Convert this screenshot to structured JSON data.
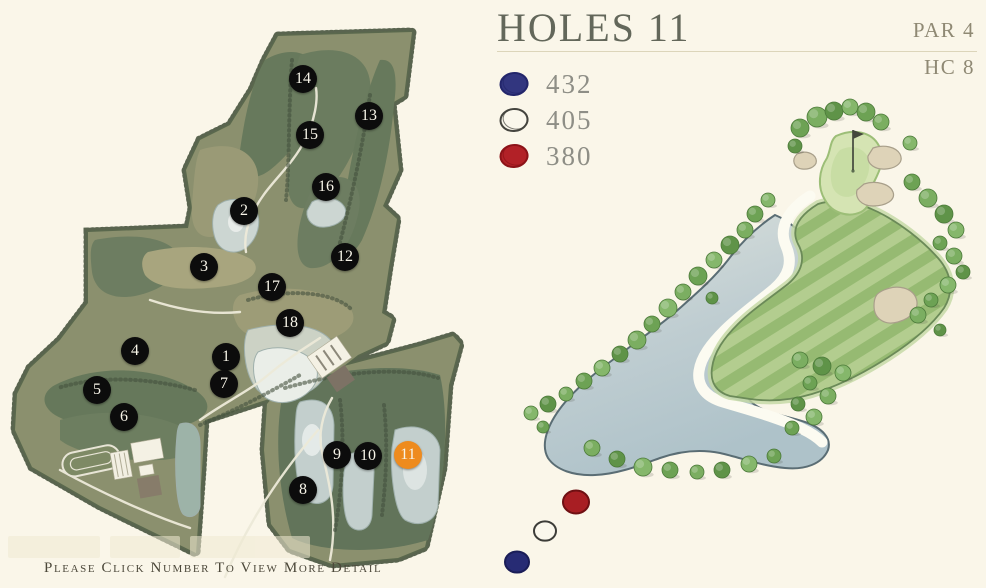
{
  "window": {
    "background": "#faf6e9"
  },
  "header": {
    "title": "HOLES 11",
    "par": "PAR 4",
    "handicap": "HC 8"
  },
  "legend": {
    "tees": [
      {
        "name": "blue-tee",
        "distance": "432",
        "fill": "#32367f",
        "outline": "#23266b"
      },
      {
        "name": "white-tee",
        "distance": "405",
        "fill": "#faf7ec",
        "outline": "#45453f"
      },
      {
        "name": "red-tee",
        "distance": "380",
        "fill": "#b22127",
        "outline": "#8c1318"
      }
    ]
  },
  "map": {
    "instruction": "Please Click Number To View More Detail",
    "active_color": "#ee8b1e",
    "marker_color": "#0c0c0c",
    "holes": [
      {
        "number": "1",
        "x": 226,
        "y": 357,
        "active": false
      },
      {
        "number": "2",
        "x": 244,
        "y": 211,
        "active": false
      },
      {
        "number": "3",
        "x": 204,
        "y": 267,
        "active": false
      },
      {
        "number": "4",
        "x": 135,
        "y": 351,
        "active": false
      },
      {
        "number": "5",
        "x": 97,
        "y": 390,
        "active": false
      },
      {
        "number": "6",
        "x": 124,
        "y": 417,
        "active": false
      },
      {
        "number": "7",
        "x": 224,
        "y": 384,
        "active": false
      },
      {
        "number": "8",
        "x": 303,
        "y": 490,
        "active": false
      },
      {
        "number": "9",
        "x": 337,
        "y": 455,
        "active": false
      },
      {
        "number": "10",
        "x": 368,
        "y": 456,
        "active": false
      },
      {
        "number": "11",
        "x": 408,
        "y": 455,
        "active": true
      },
      {
        "number": "12",
        "x": 345,
        "y": 257,
        "active": false
      },
      {
        "number": "13",
        "x": 369,
        "y": 116,
        "active": false
      },
      {
        "number": "14",
        "x": 303,
        "y": 79,
        "active": false
      },
      {
        "number": "15",
        "x": 310,
        "y": 135,
        "active": false
      },
      {
        "number": "16",
        "x": 326,
        "y": 187,
        "active": false
      },
      {
        "number": "17",
        "x": 272,
        "y": 287,
        "active": false
      },
      {
        "number": "18",
        "x": 290,
        "y": 323,
        "active": false
      }
    ]
  },
  "hole_view": {
    "tee_positions": [
      {
        "name": "red-tee-marker",
        "x": 576,
        "y": 502,
        "r": 13,
        "fill": "#a81e23",
        "outline": "#6f1013"
      },
      {
        "name": "white-tee-marker",
        "x": 545,
        "y": 531,
        "r": 11,
        "fill": "#faf7ec",
        "outline": "#3c3c38"
      },
      {
        "name": "blue-tee-marker",
        "x": 517,
        "y": 562,
        "r": 12,
        "fill": "#272b74",
        "outline": "#1a1d57"
      }
    ]
  }
}
